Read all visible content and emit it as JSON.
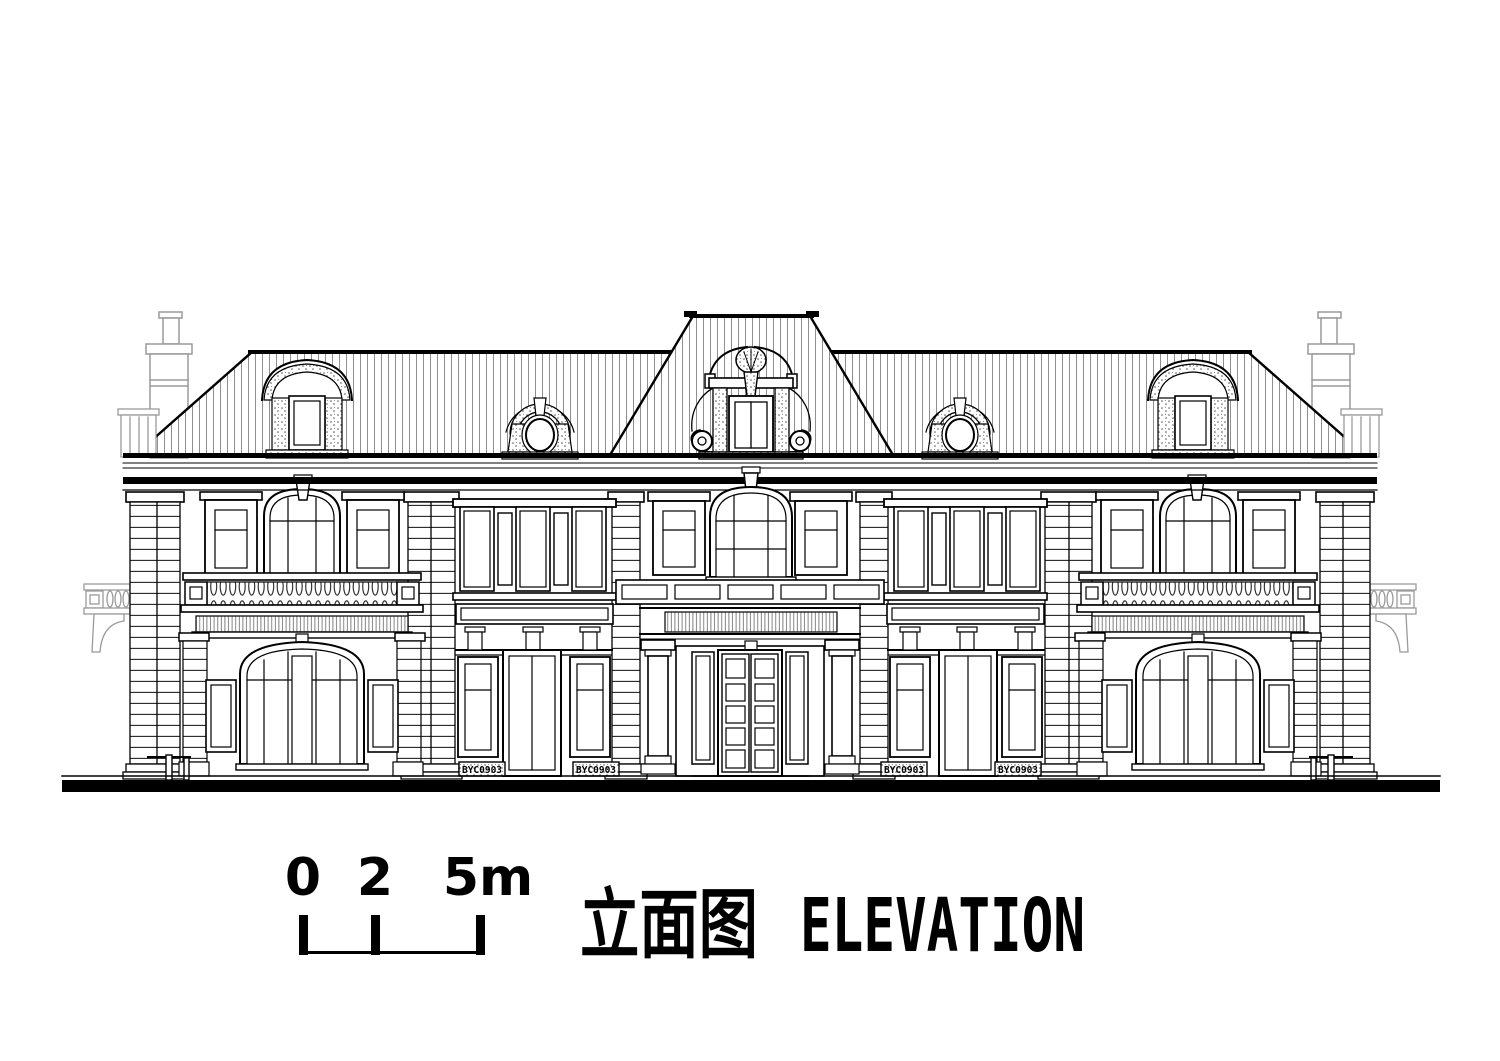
{
  "page": {
    "background": "#ffffff"
  },
  "title": {
    "cn": "立面图",
    "en": "ELEVATION"
  },
  "scale_bar": {
    "labels": [
      "0",
      "2",
      "5m"
    ]
  },
  "drawing": {
    "type": "architectural-elevation",
    "plaques": [
      "BYC0903",
      "BYC0903",
      "BYC0903",
      "BYC0903"
    ],
    "colors": {
      "line": "#000000",
      "secondary_line": "#9a9a9a",
      "paper": "#ffffff"
    }
  }
}
